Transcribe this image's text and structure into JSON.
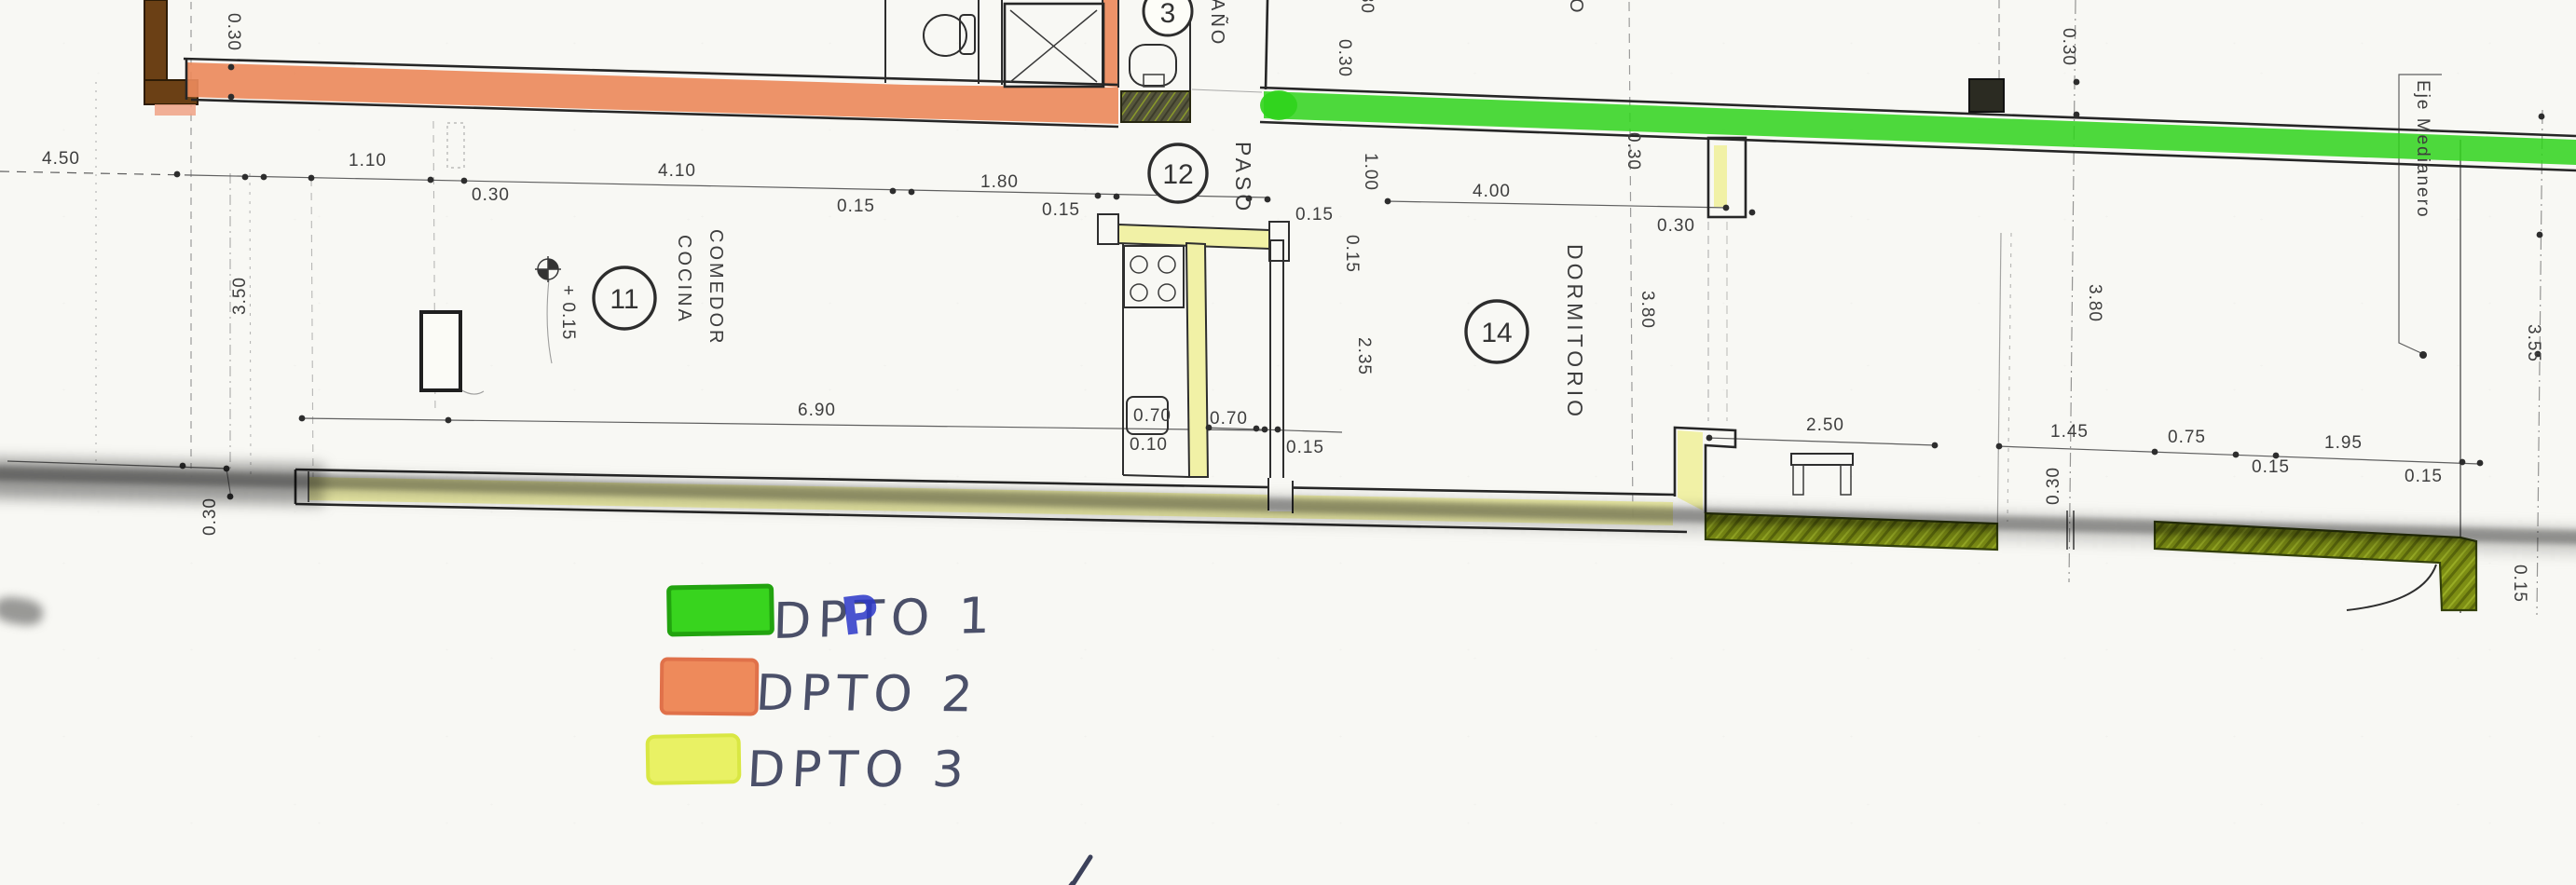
{
  "drawing": {
    "type": "architectural-floor-plan",
    "note": "scanned plan with highlighter marking of apartment walls"
  },
  "rooms": {
    "bano": {
      "number": "3",
      "label_visible": "AÑO"
    },
    "cocina_comedor": {
      "number": "11",
      "line1": "COCINA",
      "line2": "COMEDOR"
    },
    "paso": {
      "number": "12",
      "label": "PASO"
    },
    "dormitorio": {
      "number": "14",
      "label": "DORMITORIO"
    },
    "upper_room_fragment": "RIO",
    "axis_label": "Eje Medianero"
  },
  "dims": {
    "d450": "4.50",
    "d110": "1.10",
    "d030": "0.30",
    "d410": "4.10",
    "d015": "0.15",
    "d180": "1.80",
    "d400": "4.00",
    "d100": "1.00",
    "d080": "0.80",
    "d235": "2.35",
    "d350": "3.50",
    "d380": "3.80",
    "d690": "6.90",
    "d070": "0.70",
    "d010": "0.10",
    "d250": "2.50",
    "d145": "1.45",
    "d075": "0.75",
    "d195": "1.95",
    "d355": "3.55",
    "level": "+ 0.15"
  },
  "legend": {
    "items": [
      {
        "label": "DPTO 1",
        "color": "#38d41e",
        "border": "#22a30f"
      },
      {
        "label": "DPTO 2",
        "color": "#ee8a5b",
        "border": "#e0714a"
      },
      {
        "label": "DPTO 3",
        "color": "#e9f164",
        "border": "#d9e743"
      }
    ]
  },
  "colors": {
    "dpto1_wall": "#2fd31b",
    "dpto2_wall": "#ec8a5c",
    "dpto3_wall": "#f1f1a6",
    "dpto3_dark_wall": "#7d8e14",
    "brown_wall": "#6b4015",
    "pink_tail": "#f0a285",
    "ink": "#4b5069",
    "blue_ink": "#2c38c9"
  }
}
